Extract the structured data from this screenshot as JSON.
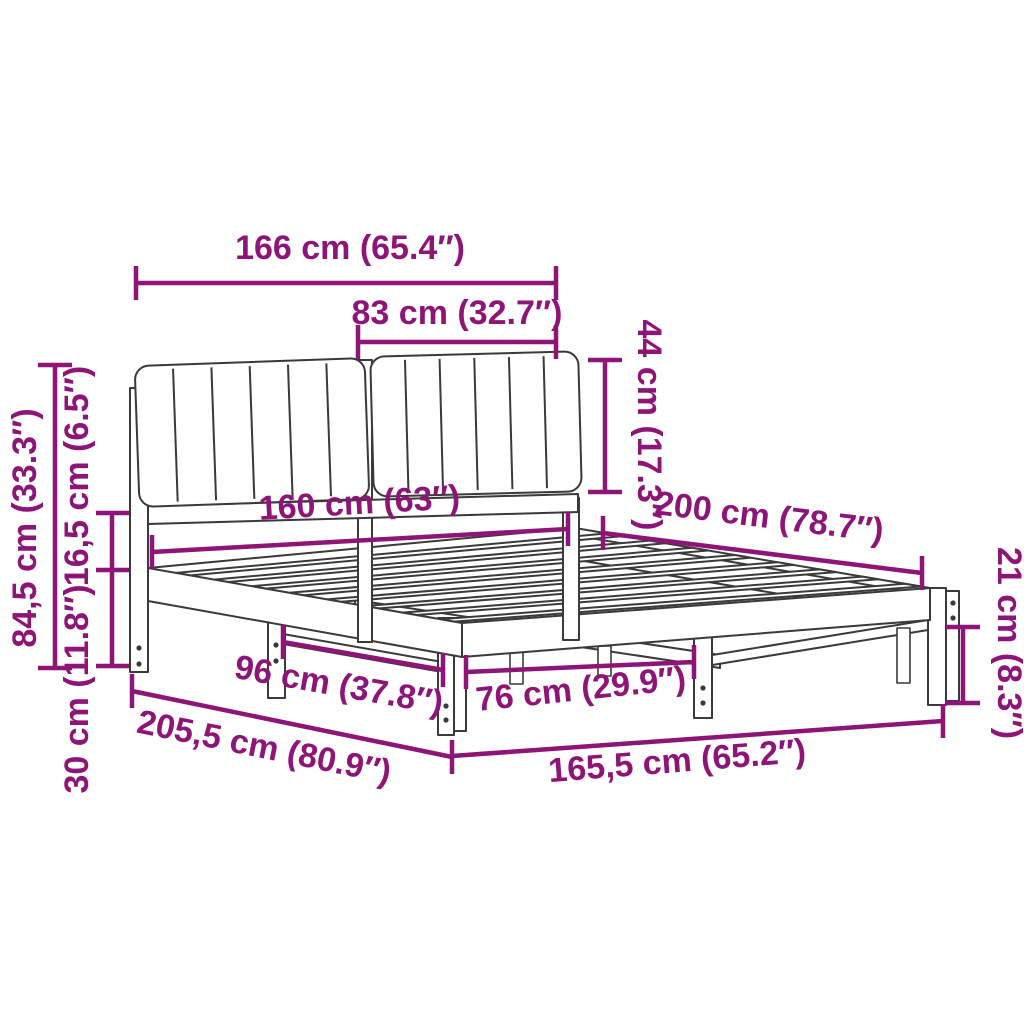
{
  "diagram": {
    "type": "furniture-dimension-diagram",
    "subject": "bed-frame-with-upholstered-headboard",
    "colors": {
      "dimension_accent": "#8E1478",
      "line_art": "#3A3A3A",
      "background": "#FFFFFF"
    },
    "dimensions": {
      "headboard_total_width": "166 cm (65.4″)",
      "cushion_width": "83 cm (32.7″)",
      "cushion_height": "44 cm (17.3″)",
      "total_height": "84,5 cm (33.3″)",
      "rail_height": "16,5 cm (6.5″)",
      "headboard_leg_height": "30 cm (11.8″)",
      "bed_width": "160 cm (63″)",
      "bed_length": "200 cm (78.7″)",
      "underbed_clearance": "21 cm (8.3″)",
      "leg_spacing_side": "96 cm (37.8″)",
      "leg_spacing_foot": "76 cm (29.9″)",
      "total_length": "205,5 cm (80.9″)",
      "frame_outer_width": "165,5 cm (65.2″)"
    }
  }
}
